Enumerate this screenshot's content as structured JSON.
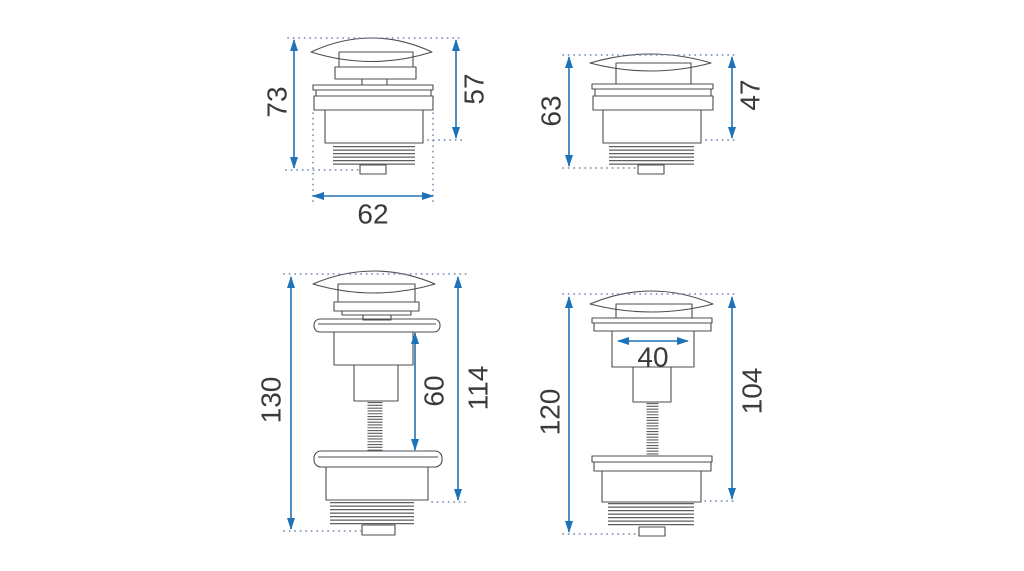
{
  "drawing": {
    "background": "#ffffff",
    "dimension_color": "#1e73b8",
    "extension_dot_color": "#7b93b3",
    "outline_color": "#4d4d4d",
    "label_color": "#3a3a3a",
    "views": [
      {
        "id": "top-left-short-plug-small-cap",
        "dims": {
          "overall_height": "73",
          "upper_height": "57",
          "width": "62"
        }
      },
      {
        "id": "top-right-short-plug-wide-cap",
        "dims": {
          "overall_height": "63",
          "upper_height": "47"
        }
      },
      {
        "id": "bottom-left-tall-plug-small-cap",
        "dims": {
          "overall_height": "130",
          "stem_height": "60",
          "body_height": "114"
        }
      },
      {
        "id": "bottom-right-tall-plug-wide-cap",
        "dims": {
          "overall_height": "120",
          "cap_width": "40",
          "body_height": "104"
        }
      }
    ]
  }
}
